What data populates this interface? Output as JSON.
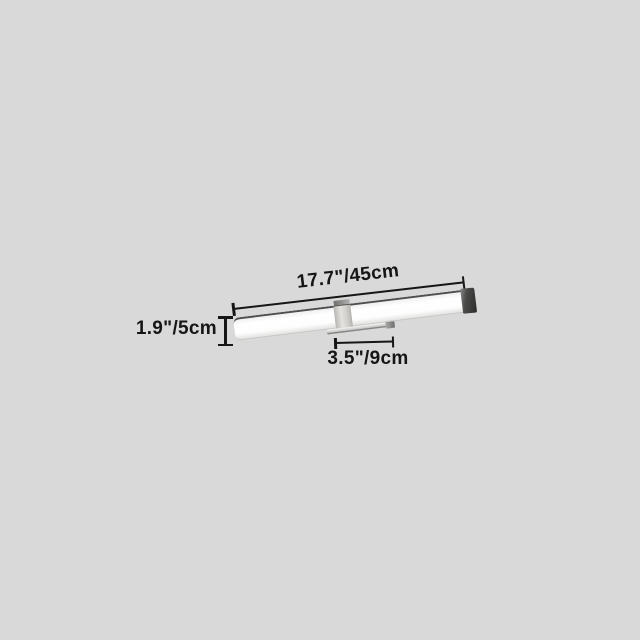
{
  "scene": {
    "type": "product-dimension-diagram",
    "product": "wall-mounted LED vanity light bar",
    "background_color": "#d9d9d9",
    "line_color": "#161616",
    "text_color": "#161616"
  },
  "dimensions": {
    "width_label": "17.7\"/45cm",
    "height_label": "1.9\"/5cm",
    "depth_label": "3.5\"/9cm"
  },
  "fixture": {
    "bar_color": "#fdfdfd",
    "bar_top_edge_color": "#4f4f4f",
    "end_cap_color": "#2d2d2b",
    "mount_clamp_color": "#cfcdc9",
    "bracket_color": "#ececea"
  }
}
